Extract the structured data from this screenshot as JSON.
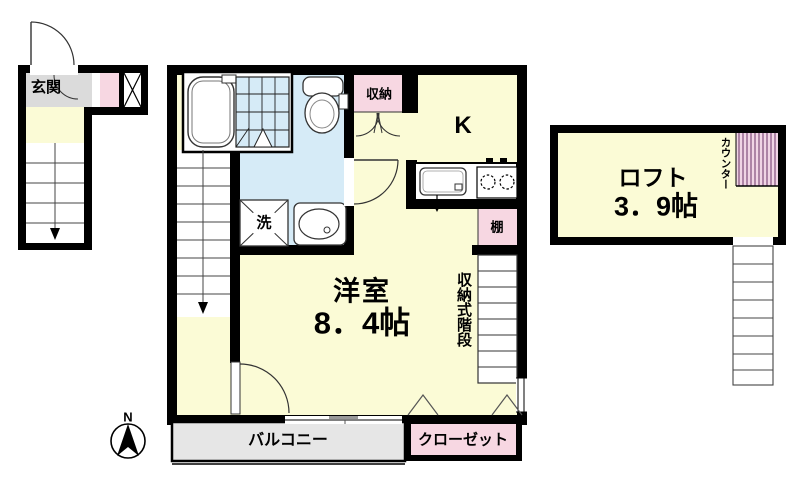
{
  "floorplan": {
    "colors": {
      "wall": "#000000",
      "floor": "#FBFBD6",
      "wet_area": "#D6EBF7",
      "pink": "#F7D7E2",
      "counter_bg": "#F1D5E5",
      "counter_stripe": "#92618C",
      "balcony_gray": "#E6E6E6",
      "entrance_gray": "#DBDBDB",
      "fixture_white": "#FFFFFF"
    },
    "entrance": {
      "label": "玄関"
    },
    "wet_area": {
      "laundry_label": "洗"
    },
    "storage": {
      "label": "収納"
    },
    "kitchen": {
      "label": "K",
      "shelf_label": "棚"
    },
    "room": {
      "name": "洋室",
      "size": "8．4帖"
    },
    "stairs": {
      "storage_stairs_label": "収納式階段"
    },
    "loft": {
      "name": "ロフト",
      "size": "3．9帖",
      "counter_label": "カウンター"
    },
    "balcony": {
      "label": "バルコニー"
    },
    "closet": {
      "label": "クローゼット"
    },
    "compass": {
      "north_label": "N"
    }
  }
}
